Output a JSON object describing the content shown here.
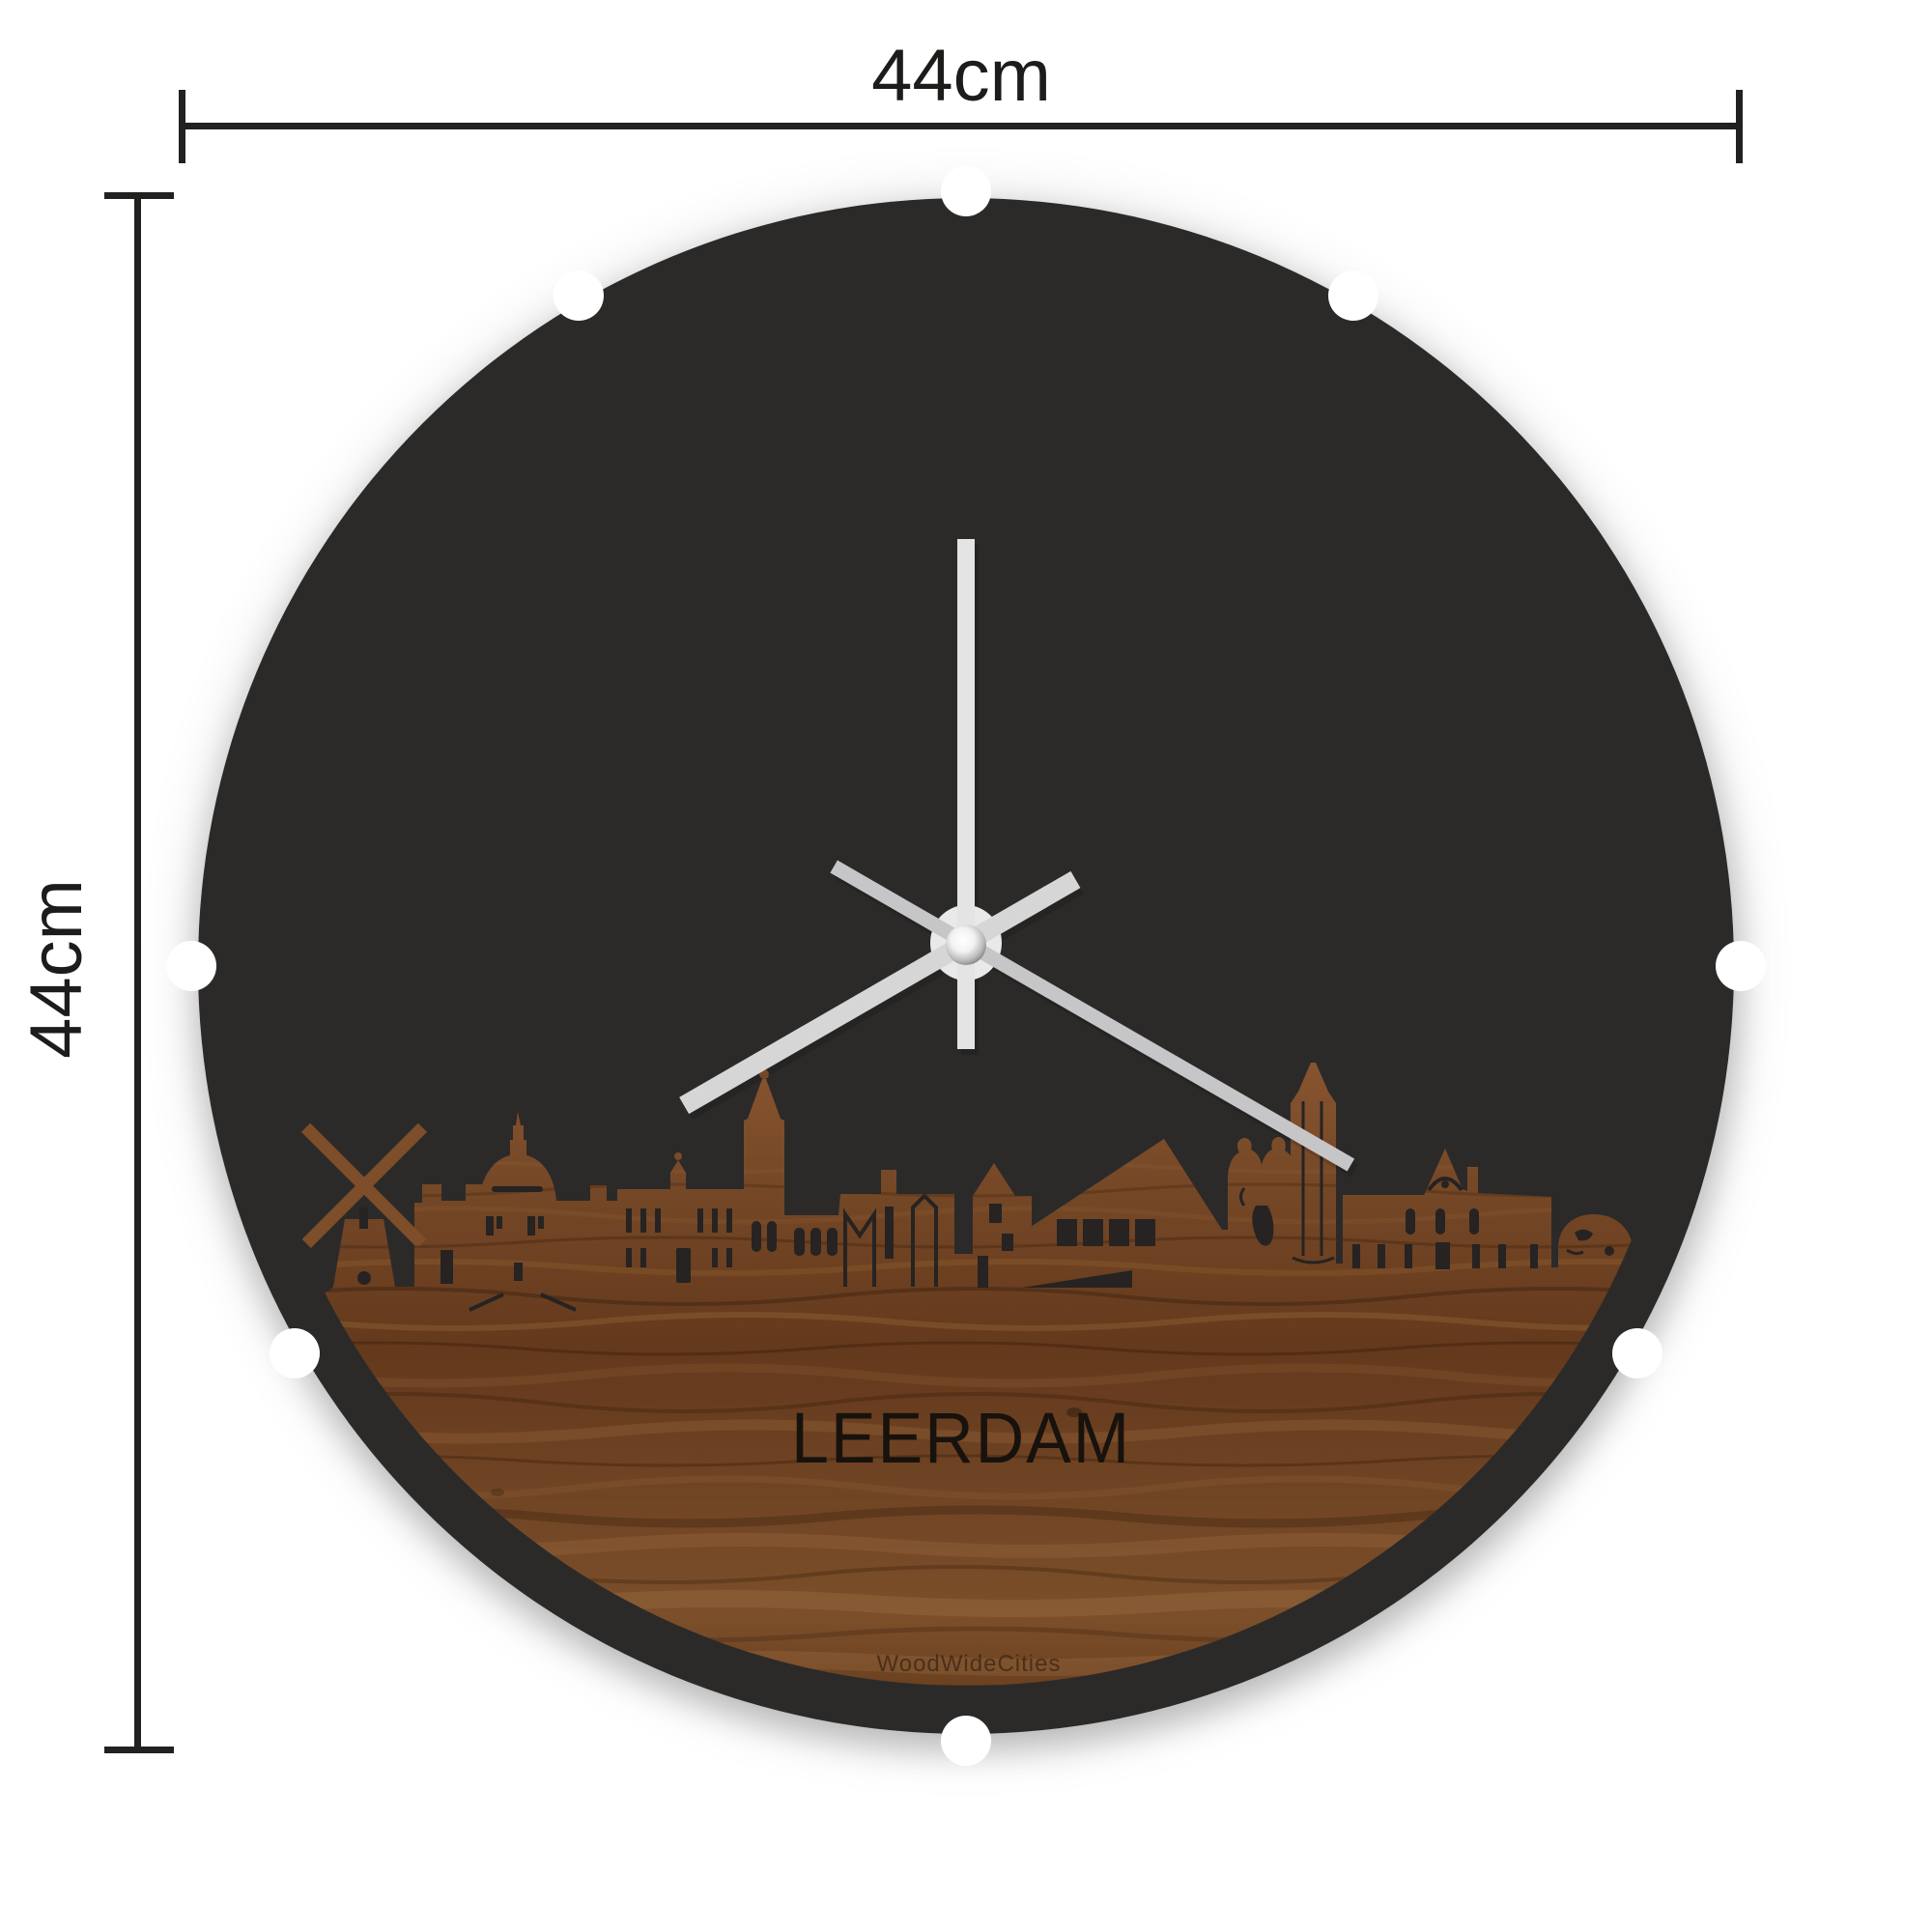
{
  "page": {
    "background": "#ffffff"
  },
  "dimensions": {
    "width_label": "44cm",
    "height_label": "44cm"
  },
  "product": {
    "type": "skyline wall clock",
    "city_name": "LEERDAM",
    "brand_watermark": "WoodWideCities"
  },
  "clock": {
    "face_color": "#2b2a29",
    "cutout_color": "#262322",
    "wood_tone": "#6b4226",
    "hand_color_minute": "#e4e4e4",
    "hand_color_hour": "#d6d6d6",
    "hand_color_second": "#c6c6c8",
    "mount_notches": 8,
    "hands": {
      "minute": {
        "transform": "rotate(0 1000 976)"
      },
      "hour": {
        "transform": "rotate(240 1000 976)"
      },
      "second": {
        "transform": "rotate(120 1000 976)"
      }
    }
  }
}
